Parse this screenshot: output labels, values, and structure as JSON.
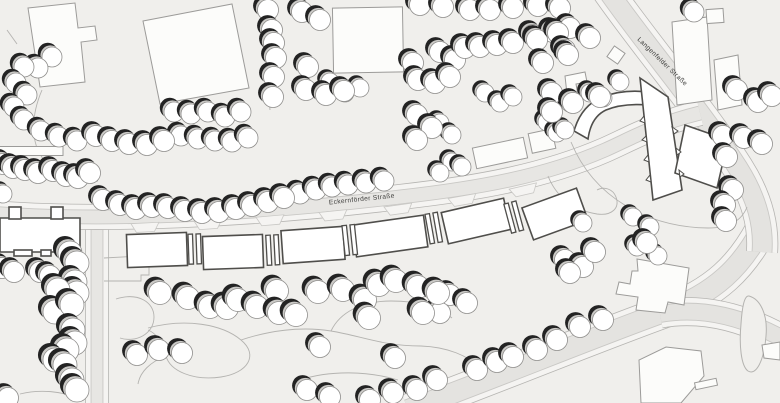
{
  "map": {
    "canvas": {
      "width": 780,
      "height": 403
    },
    "palette": {
      "bg": "#f0efec",
      "road_surface": "#e7e6e3",
      "road_surface_dark": "#e4e3e0",
      "sidewalk": "#f5f4f2",
      "curb": "#c9c8c5",
      "road_edge": "#b6b5b2",
      "path_line": "#b4b3b0",
      "light_fill": "#fcfcfa",
      "light_stroke": "#9c9b99",
      "heavy_fill": "#ffffff",
      "heavy_stroke": "#4f4e4b",
      "tree_shadow": "#232323",
      "tree_mid": "#cbcac7",
      "tree_stroke": "#8f8e8c",
      "label": "#3d3d3b"
    },
    "streets": [
      {
        "id": "eckernfoerder-strasse",
        "name": "Eckernförder Straße",
        "label": {
          "x": 362,
          "y": 201,
          "rotation": -6,
          "font_size": 6.6
        }
      },
      {
        "id": "langenfelder-strasse",
        "name": "Langenfelder Straße",
        "label": {
          "x": 661,
          "y": 63,
          "rotation": 44,
          "font_size": 6.6
        }
      }
    ],
    "roads": [
      {
        "id": "bottom-road",
        "dark": true,
        "w": 20,
        "d": "M 408,410 C 500,376 592,338 664,312 C 716,293 742,266 762,228"
      },
      {
        "id": "east-branch",
        "dark": true,
        "w": 16,
        "d": "M 660,314 C 704,306 748,318 792,344"
      },
      {
        "id": "langenfelder-strasse",
        "dark": true,
        "w": 19,
        "d": "M 603,-16 C 638,36 700,108 738,168 C 757,198 764,225 762,252"
      },
      {
        "id": "side-road",
        "dark": false,
        "w": 11,
        "d": "M 97,214 L 97,410"
      },
      {
        "id": "eckernfoerder-strasse",
        "dark": false,
        "w": 13,
        "d": "M -10,213 C 100,222 250,215 400,197 C 480,188 545,176 605,150 C 630,139 655,124 700,113"
      }
    ],
    "island": "M 749,296 C 760,299 768,314 766,336 C 764,361 756,376 748,371 C 741,366 739,345 741,324 C 742,309 744,295 749,296 Z",
    "decor_paths": [
      "M 42,90 C 30,118 30,148 48,164 C 62,176 82,181 98,181",
      "M 7,30 L 17,44",
      "M 104,258 L 141,256 L 141,262 L 149,262 L 149,275 L 141,275 L 141,281 L 104,281",
      "M 116,299 C 138,292 154,302 154,317 C 154,334 136,343 120,338",
      "M 20,394 C 40,389 62,391 80,399",
      "M 148,328 C 185,318 222,324 241,340 C 259,355 248,373 221,377 C 193,381 170,371 166,356 C 163,344 158,334 148,330",
      "M 241,340 C 268,331 300,326 331,331 C 362,336 382,346 421,346",
      "M 331,331 C 340,312 362,301 391,301 C 420,301 440,308 452,318",
      "M 421,346 C 448,347 468,356 479,367",
      "M 166,356 C 150,362 140,372 138,384",
      "M 571,142 C 594,198 648,227 708,228 C 730,228 742,220 747,207",
      "M 260,0 L 270,110",
      "M 548,176 C 556,196 572,210 597,214 C 612,216 620,208 616,197 C 613,189 604,186 597,190",
      "M 300,380 C 330,370 368,371 398,380"
    ],
    "aprons": [
      [
        145,
        224,
        -3
      ],
      [
        208,
        221,
        -4
      ],
      [
        270,
        217,
        -5
      ],
      [
        333,
        212,
        -6
      ],
      [
        398,
        206,
        -8
      ],
      [
        462,
        197,
        -10
      ],
      [
        523,
        187,
        -13
      ]
    ],
    "buildings_light": [
      {
        "pts": "28,8 75,3 78,28 95,26 97,40 81,42 85,82 40,87"
      },
      {
        "pts": "143,21 232,4 249,88 160,104"
      },
      {
        "r": [
          368,
          40,
          70,
          65,
          -1
        ]
      },
      {
        "r": [
          500,
          153,
          52,
          21,
          -12
        ]
      },
      {
        "r": [
          542,
          141,
          24,
          20,
          -12
        ]
      },
      {
        "pts": "565,76 585,72 587,82 576,84 579,101 568,103"
      },
      {
        "r": [
          616,
          55,
          13,
          13,
          35
        ]
      },
      {
        "pts": "672,22 707,17 712,100 677,105"
      },
      {
        "pts": "714,60 738,55 742,105 718,110"
      },
      {
        "r": [
          715,
          16,
          17,
          14,
          -4
        ]
      },
      {
        "pts": "637,259 689,268 684,305 668,302 665,313 636,310 638,297 616,294 619,282 630,284 632,271 638,271"
      },
      {
        "pts": "641,403 639,360 666,347 701,351 704,376 681,403"
      },
      {
        "r": [
          706,
          384,
          22,
          7,
          -12
        ]
      },
      {
        "pts": "762,345 780,342 780,360 764,358"
      },
      {
        "r": [
          29,
          151,
          68,
          9,
          0
        ]
      }
    ],
    "buildings_heavy": [
      {
        "pts": "0,218 80,218 80,252 0,252"
      },
      {
        "r": [
          15,
          213,
          12,
          12,
          0
        ]
      },
      {
        "r": [
          57,
          213,
          12,
          12,
          0
        ]
      },
      {
        "r": [
          23,
          253,
          18,
          6,
          0
        ]
      },
      {
        "r": [
          46,
          253,
          10,
          6,
          0
        ]
      },
      {
        "r": [
          157,
          250,
          60,
          33,
          -2
        ]
      },
      {
        "r": [
          233,
          252,
          60,
          33,
          -2
        ]
      },
      {
        "r": [
          313,
          245,
          62,
          33,
          -4
        ]
      },
      {
        "r": [
          390,
          236,
          72,
          32,
          -8
        ]
      },
      {
        "r": [
          476,
          221,
          64,
          32,
          -13
        ]
      },
      {
        "r": [
          555,
          214,
          58,
          34,
          -20
        ]
      },
      {
        "d": "M 574,131 Q 581,106 602,97 Q 624,89 647,92 L 649,105 Q 623,103 606,110 Q 591,117 588,139 Z"
      },
      {
        "pts": "640,78 668,97 682,190 653,200"
      },
      {
        "pts": "685,125 728,140 717,188 675,173"
      }
    ],
    "teeth": [
      "644,116 645,123 640,121",
      "646,136 647,142 642,140",
      "648,155 649,162 644,160",
      "650,175 651,182 646,180",
      "672,127 674,134 678,131",
      "676,148 677,155 681,152",
      "679,170 680,177 684,174"
    ],
    "connectors": [
      [
        195,
        249,
        -2
      ],
      [
        273,
        250,
        -3
      ],
      [
        350,
        240,
        -6
      ],
      [
        434,
        228,
        -10
      ],
      [
        514,
        217,
        -15
      ]
    ],
    "trees": [
      {
        "r": 9,
        "pts": [
          [
            3,
            194
          ],
          [
            330,
            82
          ],
          [
            345,
            93
          ],
          [
            360,
            88
          ],
          [
            485,
            93
          ],
          [
            500,
            103
          ],
          [
            513,
            97
          ],
          [
            440,
            123
          ],
          [
            452,
            135
          ],
          [
            452,
            162
          ],
          [
            462,
            167
          ],
          [
            440,
            173
          ],
          [
            547,
            122
          ],
          [
            557,
            133
          ],
          [
            590,
            93
          ],
          [
            603,
            98
          ],
          [
            620,
            82
          ],
          [
            570,
            103
          ],
          [
            565,
            130
          ],
          [
            583,
            223
          ],
          [
            633,
            217
          ],
          [
            650,
            227
          ],
          [
            637,
            247
          ],
          [
            658,
            256
          ]
        ]
      },
      {
        "r": 10,
        "pts": [
          [
            52,
            57
          ],
          [
            38,
            68
          ],
          [
            24,
            67
          ],
          [
            16,
            83
          ],
          [
            27,
            95
          ],
          [
            14,
            107
          ],
          [
            24,
            120
          ],
          [
            41,
            131
          ],
          [
            59,
            137
          ],
          [
            77,
            141
          ],
          [
            174,
            112
          ],
          [
            191,
            114
          ],
          [
            208,
            112
          ],
          [
            225,
            117
          ],
          [
            241,
            112
          ],
          [
            181,
            136
          ],
          [
            198,
            139
          ],
          [
            215,
            141
          ],
          [
            232,
            142
          ],
          [
            248,
            138
          ],
          [
            300,
            194
          ],
          [
            316,
            190
          ],
          [
            332,
            187
          ],
          [
            348,
            185
          ],
          [
            366,
            183
          ],
          [
            384,
            181
          ],
          [
            694,
            12
          ]
        ]
      },
      {
        "r": 10.5,
        "pts": [
          [
            3,
            164
          ],
          [
            13,
            168
          ],
          [
            25,
            170
          ],
          [
            38,
            173
          ],
          [
            53,
            171
          ],
          [
            66,
            176
          ],
          [
            78,
            178
          ],
          [
            90,
            173
          ],
          [
            96,
            136
          ],
          [
            112,
            141
          ],
          [
            129,
            144
          ],
          [
            147,
            145
          ],
          [
            164,
            141
          ],
          [
            103,
            200
          ],
          [
            120,
            205
          ],
          [
            136,
            209
          ],
          [
            152,
            207
          ],
          [
            168,
            208
          ],
          [
            185,
            211
          ],
          [
            202,
            213
          ],
          [
            219,
            212
          ],
          [
            236,
            209
          ],
          [
            252,
            206
          ],
          [
            268,
            202
          ],
          [
            284,
            198
          ],
          [
            268,
            10
          ],
          [
            272,
            30
          ],
          [
            274,
            43
          ],
          [
            276,
            58
          ],
          [
            274,
            77
          ],
          [
            273,
            97
          ],
          [
            302,
            12
          ],
          [
            320,
            20
          ],
          [
            308,
            67
          ],
          [
            306,
            90
          ],
          [
            326,
            95
          ],
          [
            344,
            91
          ],
          [
            420,
            5
          ],
          [
            443,
            7
          ],
          [
            470,
            10
          ],
          [
            490,
            10
          ],
          [
            513,
            8
          ],
          [
            538,
            6
          ],
          [
            560,
            8
          ],
          [
            440,
            52
          ],
          [
            455,
            60
          ],
          [
            465,
            48
          ],
          [
            413,
            63
          ],
          [
            418,
            80
          ],
          [
            435,
            83
          ],
          [
            450,
            77
          ],
          [
            480,
            47
          ],
          [
            497,
            45
          ],
          [
            513,
            43
          ],
          [
            533,
            35
          ],
          [
            553,
            32
          ],
          [
            570,
            28
          ],
          [
            537,
            40
          ],
          [
            558,
            33
          ],
          [
            565,
            50
          ],
          [
            543,
            63
          ],
          [
            568,
            55
          ],
          [
            590,
            38
          ],
          [
            552,
            93
          ],
          [
            573,
            103
          ],
          [
            600,
            97
          ],
          [
            552,
            112
          ],
          [
            417,
            115
          ],
          [
            432,
            128
          ],
          [
            417,
            140
          ],
          [
            737,
            90
          ],
          [
            758,
            102
          ],
          [
            772,
            96
          ],
          [
            723,
            136
          ],
          [
            744,
            138
          ],
          [
            762,
            144
          ],
          [
            727,
            157
          ],
          [
            733,
            190
          ],
          [
            725,
            205
          ],
          [
            726,
            221
          ],
          [
            565,
            260
          ],
          [
            583,
            267
          ],
          [
            595,
            252
          ],
          [
            570,
            273
          ],
          [
            647,
            243
          ],
          [
            2,
            268
          ],
          [
            14,
            272
          ],
          [
            40,
            272
          ],
          [
            50,
            276
          ],
          [
            137,
            355
          ],
          [
            159,
            350
          ],
          [
            182,
            353
          ],
          [
            320,
            347
          ],
          [
            395,
            358
          ],
          [
            307,
            390
          ],
          [
            330,
            397
          ],
          [
            370,
            400
          ],
          [
            393,
            393
          ],
          [
            417,
            390
          ],
          [
            437,
            380
          ],
          [
            450,
            295
          ],
          [
            467,
            303
          ],
          [
            440,
            313
          ],
          [
            8,
            398
          ],
          [
            477,
            370
          ],
          [
            497,
            362
          ],
          [
            513,
            357
          ],
          [
            537,
            350
          ],
          [
            557,
            340
          ],
          [
            580,
            327
          ],
          [
            603,
            320
          ]
        ]
      },
      {
        "r": 11.5,
        "pts": [
          [
            160,
            293
          ],
          [
            188,
            298
          ],
          [
            210,
            307
          ],
          [
            227,
            308
          ],
          [
            238,
            300
          ],
          [
            257,
            307
          ],
          [
            277,
            291
          ],
          [
            279,
            313
          ],
          [
            296,
            315
          ],
          [
            318,
            292
          ],
          [
            343,
            290
          ],
          [
            365,
            300
          ],
          [
            369,
            318
          ],
          [
            379,
            285
          ],
          [
            396,
            281
          ],
          [
            418,
            287
          ],
          [
            423,
            313
          ],
          [
            438,
            293
          ]
        ]
      },
      {
        "r": 12,
        "pts": [
          [
            70,
            253
          ],
          [
            77,
            263
          ],
          [
            75,
            282
          ],
          [
            77,
            293
          ],
          [
            58,
            290
          ],
          [
            55,
            312
          ],
          [
            72,
            305
          ],
          [
            73,
            330
          ],
          [
            75,
            343
          ],
          [
            67,
            350
          ],
          [
            55,
            360
          ],
          [
            65,
            365
          ],
          [
            72,
            380
          ],
          [
            77,
            390
          ]
        ]
      }
    ]
  }
}
